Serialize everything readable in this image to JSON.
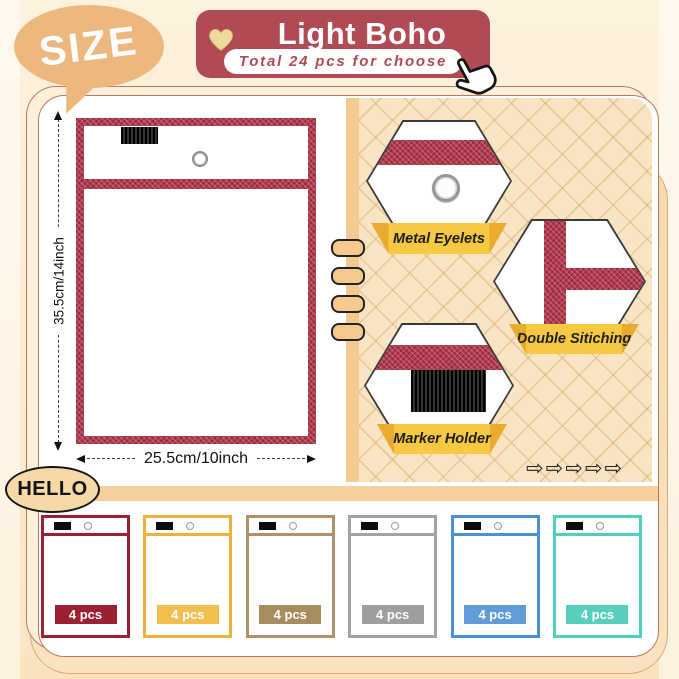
{
  "size_bubble": {
    "label": "SIZE"
  },
  "banner": {
    "title": "Light Boho",
    "subtitle": "Total 24 pcs for choose"
  },
  "diagram": {
    "height_label": "35.5cm/14inch",
    "width_label": "25.5cm/10inch"
  },
  "features": [
    {
      "label": "Metal Eyelets"
    },
    {
      "label": "Double Sitiching"
    },
    {
      "label": "Marker Holder"
    }
  ],
  "panel": {
    "arrow_glyph": "⇨"
  },
  "hello": {
    "label": "HELLO"
  },
  "products": [
    {
      "name": "dark-red",
      "border_hex": "#9b2033",
      "badge_hex": "#9b2033",
      "qty": "4 pcs"
    },
    {
      "name": "yellow",
      "border_hex": "#edb23e",
      "badge_hex": "#f0c04f",
      "qty": "4 pcs"
    },
    {
      "name": "khaki",
      "border_hex": "#b0916a",
      "badge_hex": "#a98b60",
      "qty": "4 pcs"
    },
    {
      "name": "gray",
      "border_hex": "#a3a3a3",
      "badge_hex": "#9e9e9e",
      "qty": "4 pcs"
    },
    {
      "name": "blue",
      "border_hex": "#4d90d6",
      "badge_hex": "#5f9cd8",
      "qty": "4 pcs"
    },
    {
      "name": "teal",
      "border_hex": "#4ed0bf",
      "badge_hex": "#58cfbd",
      "qty": "4 pcs"
    }
  ],
  "colors": {
    "banner_red": "#b04a54",
    "pocket_red": "#b23b4f",
    "ribbon_yellow": "#f7c943",
    "panel_tan": "#f9e5c4",
    "bar_tan": "#f5cf9e",
    "bubble_tan": "#edb87e"
  }
}
